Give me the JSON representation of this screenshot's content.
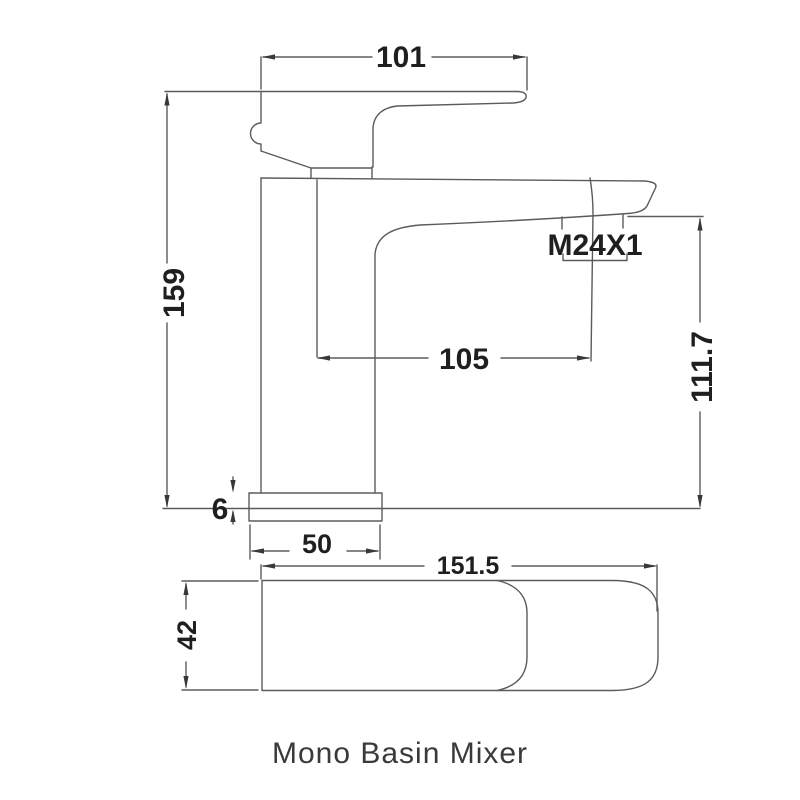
{
  "caption": "Mono Basin Mixer",
  "labels": {
    "handle_length": "101",
    "overall_height": "159",
    "spout_reach": "105",
    "thread_spec": "M24X1",
    "spout_height": "111.7",
    "base_thickness": "6",
    "base_width": "50",
    "lever_length": "151.5",
    "lever_width": "42"
  },
  "colors": {
    "line": "#5b5b5b",
    "text": "#1f1f1f",
    "background": "#ffffff"
  }
}
